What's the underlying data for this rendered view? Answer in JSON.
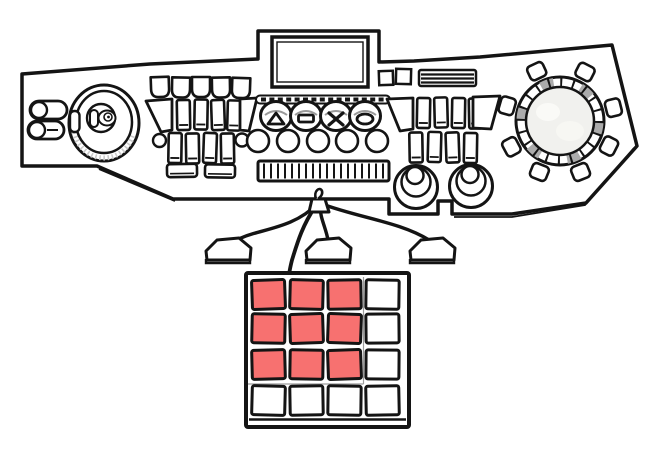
{
  "illustration": {
    "type": "line-drawing",
    "subject": "control console with trackball, button clusters, jog dial, foot pedals and 4x4 keypad"
  },
  "colors": {
    "outline": "#141414",
    "panel_fill": "#ffffff",
    "keypad_active": "#f77170",
    "keypad_inactive": "#ffffff",
    "dial_face": "#f1f1ee",
    "dial_segment_gray": "#ababab",
    "shading_gray": "#c9c9c9"
  },
  "console": {
    "display": {
      "content": ""
    },
    "trackball": {
      "present": true
    },
    "symbol_buttons": [
      {
        "symbol": "triangle"
      },
      {
        "symbol": "square"
      },
      {
        "symbol": "cross"
      },
      {
        "symbol": "oval"
      }
    ],
    "left_slider_count": 2,
    "round_button_row_count": 5,
    "rotary_knob_count": 2,
    "jog_dial_button_count": 8,
    "pedal_count": 3
  },
  "keypad": {
    "rows": 4,
    "cols": 4,
    "cells": [
      {
        "row": 1,
        "col": 1,
        "active": true,
        "color": "#f77170"
      },
      {
        "row": 1,
        "col": 2,
        "active": true,
        "color": "#f77170"
      },
      {
        "row": 1,
        "col": 3,
        "active": true,
        "color": "#f77170"
      },
      {
        "row": 1,
        "col": 4,
        "active": false,
        "color": "#ffffff"
      },
      {
        "row": 2,
        "col": 1,
        "active": true,
        "color": "#f77170"
      },
      {
        "row": 2,
        "col": 2,
        "active": true,
        "color": "#f77170"
      },
      {
        "row": 2,
        "col": 3,
        "active": true,
        "color": "#f77170"
      },
      {
        "row": 2,
        "col": 4,
        "active": false,
        "color": "#ffffff"
      },
      {
        "row": 3,
        "col": 1,
        "active": true,
        "color": "#f77170"
      },
      {
        "row": 3,
        "col": 2,
        "active": true,
        "color": "#f77170"
      },
      {
        "row": 3,
        "col": 3,
        "active": true,
        "color": "#f77170"
      },
      {
        "row": 3,
        "col": 4,
        "active": false,
        "color": "#ffffff"
      },
      {
        "row": 4,
        "col": 1,
        "active": false,
        "color": "#ffffff"
      },
      {
        "row": 4,
        "col": 2,
        "active": false,
        "color": "#ffffff"
      },
      {
        "row": 4,
        "col": 3,
        "active": false,
        "color": "#ffffff"
      },
      {
        "row": 4,
        "col": 4,
        "active": false,
        "color": "#ffffff"
      }
    ]
  }
}
